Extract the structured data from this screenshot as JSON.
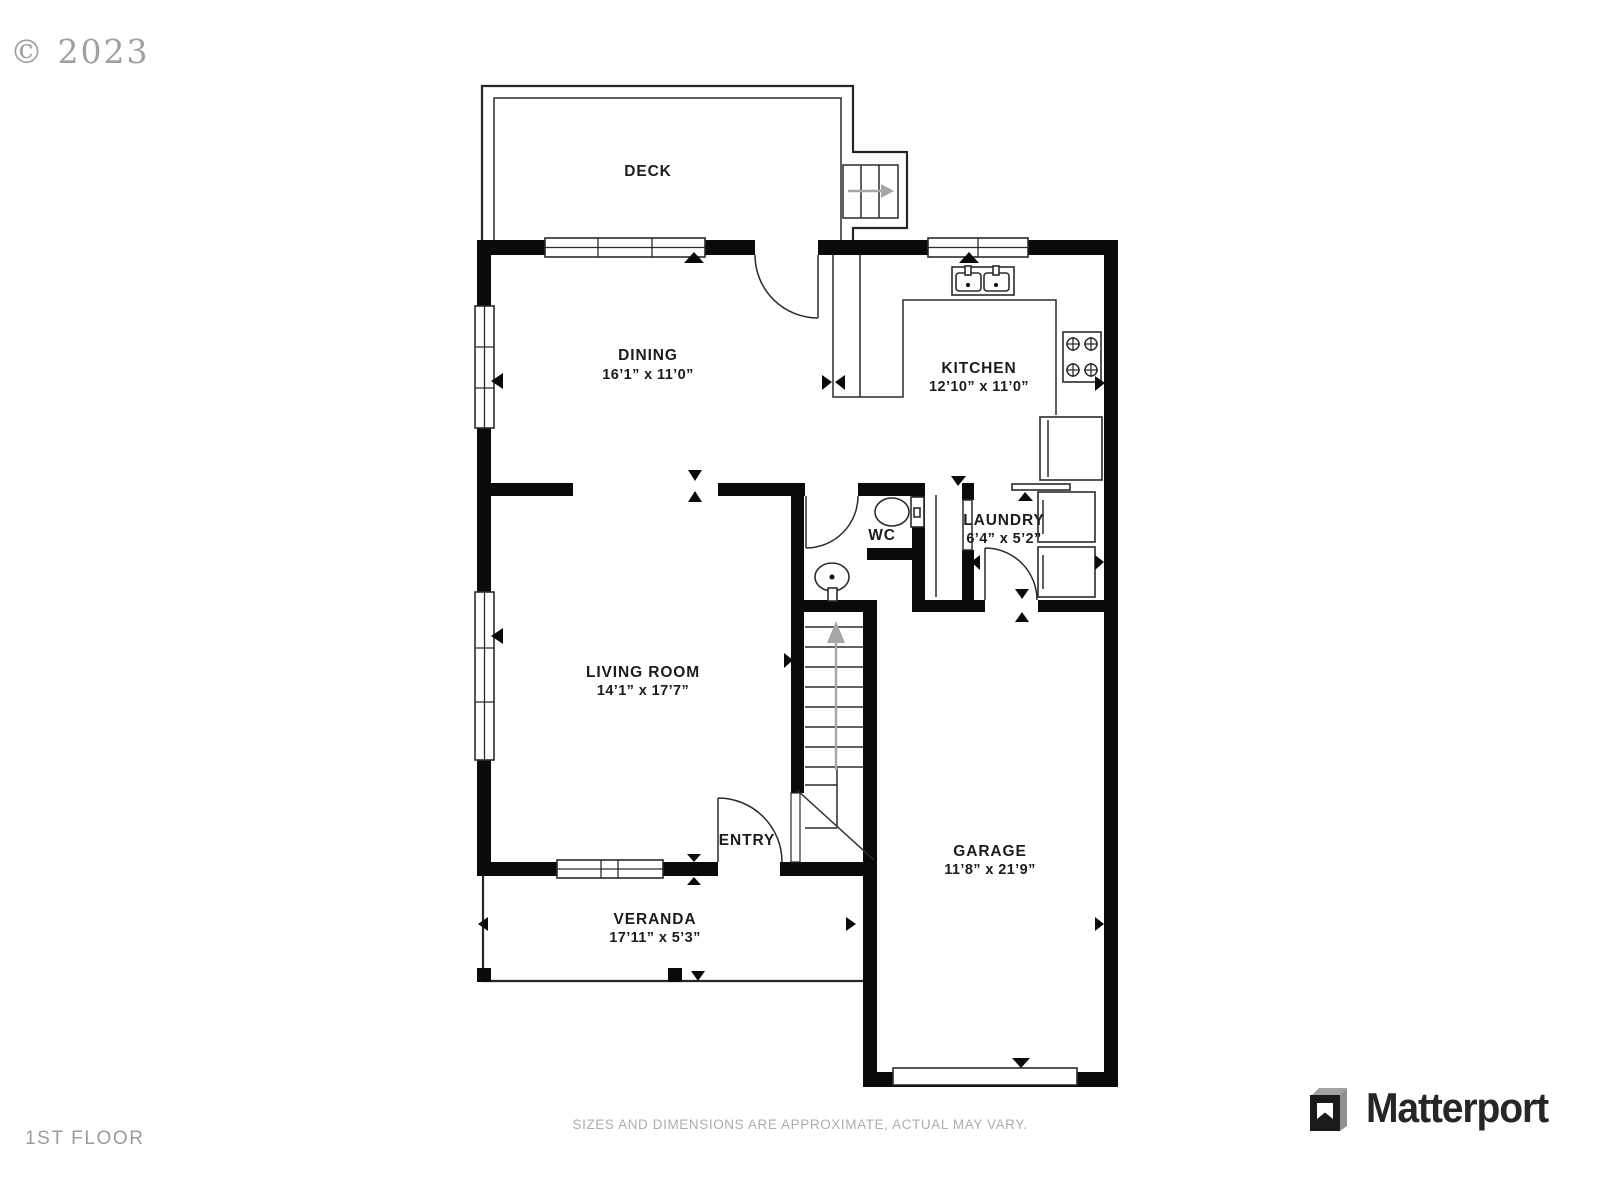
{
  "page": {
    "copyright": "© 2023",
    "floor_label": "1ST FLOOR",
    "disclaimer": "SIZES AND DIMENSIONS ARE APPROXIMATE, ACTUAL MAY VARY.",
    "brand": "Matterport"
  },
  "rooms": [
    {
      "name": "DECK",
      "dims": ""
    },
    {
      "name": "DINING",
      "dims": "16’1” x 11’0”"
    },
    {
      "name": "KITCHEN",
      "dims": "12’10” x 11’0”"
    },
    {
      "name": "WC",
      "dims": ""
    },
    {
      "name": "LAUNDRY",
      "dims": "6’4” x 5’2”"
    },
    {
      "name": "LIVING ROOM",
      "dims": "14’1” x 17’7”"
    },
    {
      "name": "ENTRY",
      "dims": ""
    },
    {
      "name": "GARAGE",
      "dims": "11’8” x 21’9”"
    },
    {
      "name": "VERANDA",
      "dims": "17’11” x 5’3”"
    }
  ]
}
